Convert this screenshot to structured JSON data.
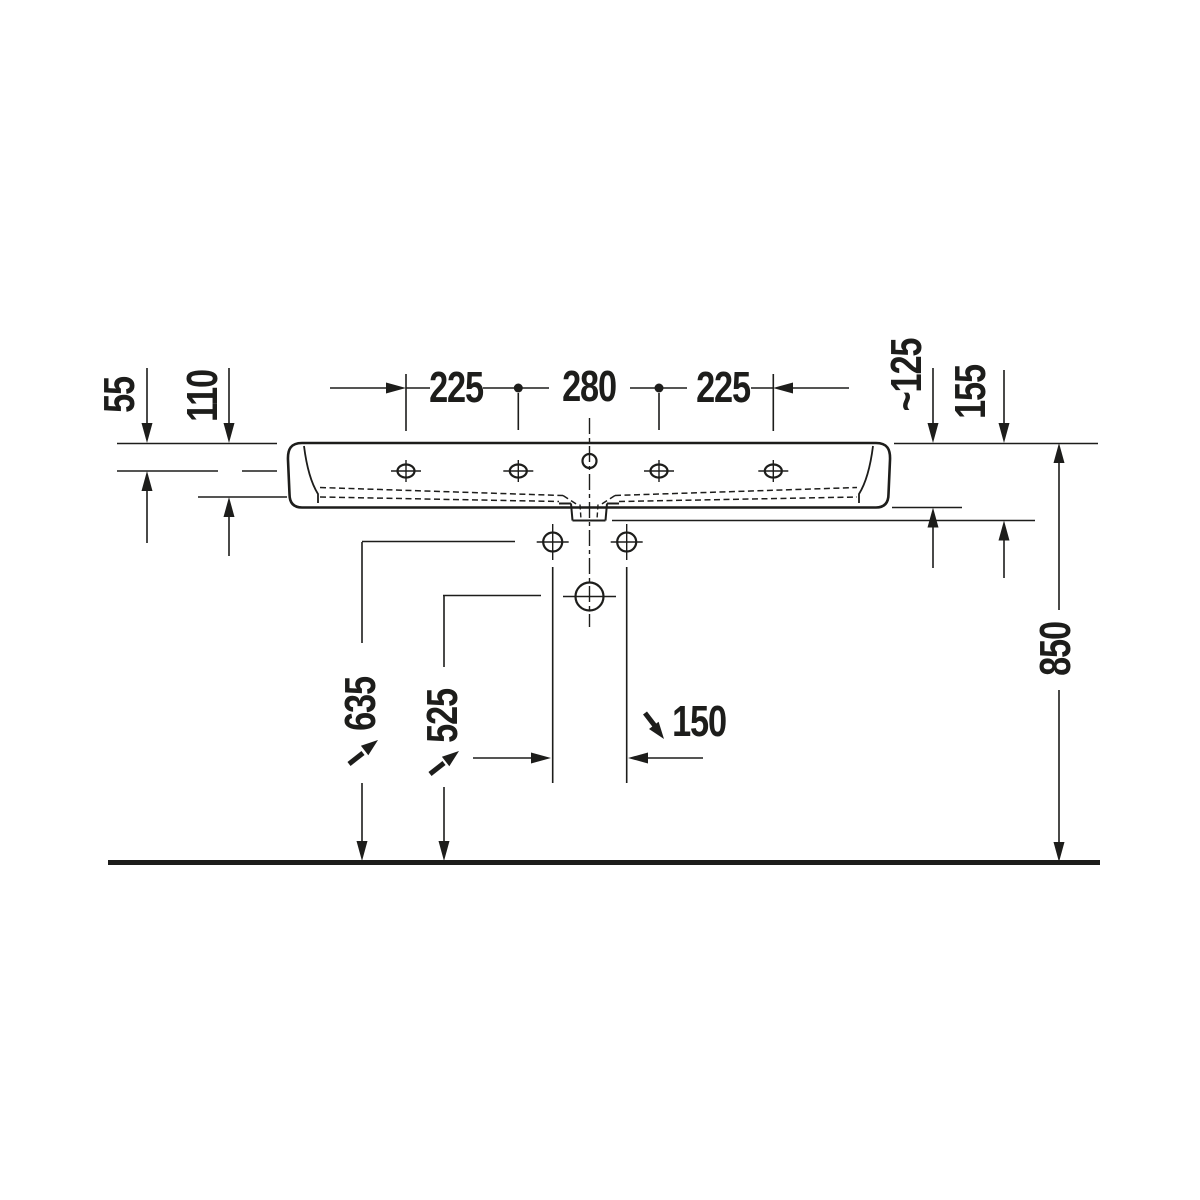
{
  "drawing": {
    "type": "washbasin front elevation technical drawing",
    "dimensions": {
      "faucet_spacing_left": "225",
      "faucet_spacing_center": "280",
      "faucet_spacing_right": "225",
      "top_to_hole_axis": "55",
      "top_to_basin_floor": "110",
      "front_apron_depth": "~125",
      "total_body_depth": "155",
      "rim_height_from_floor": "850",
      "fixing_holes_height": "635",
      "trap_hole_height": "525",
      "fixing_holes_spacing": "150"
    },
    "colors": {
      "line": "#1d1d1b",
      "background": "#ffffff"
    }
  }
}
